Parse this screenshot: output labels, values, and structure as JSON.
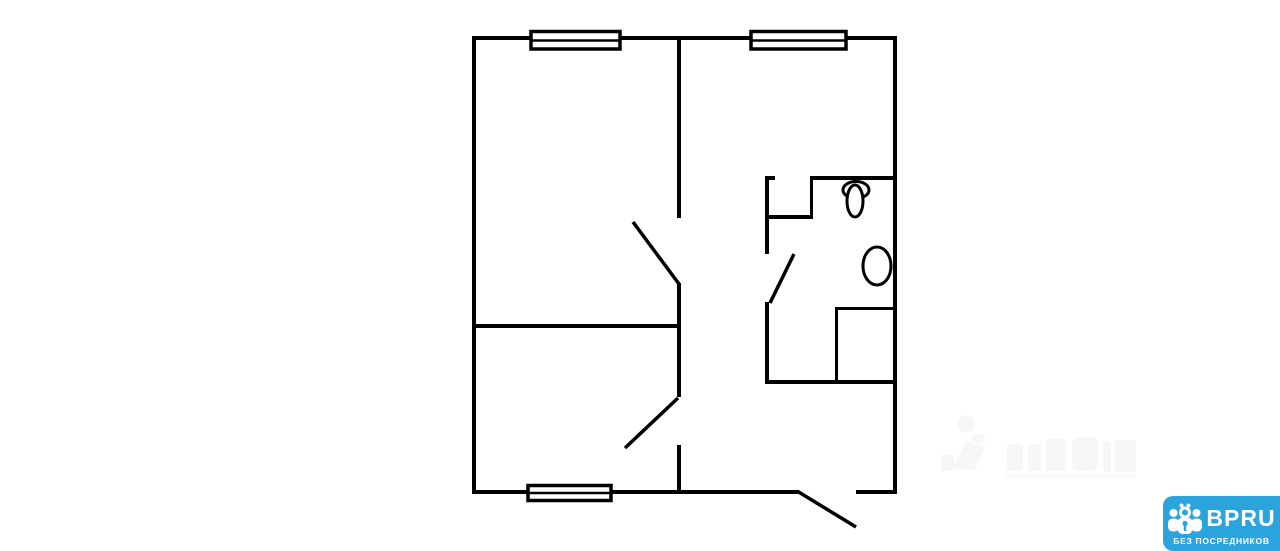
{
  "canvas": {
    "width": 1280,
    "height": 551,
    "background": "#ffffff"
  },
  "floorplan": {
    "line_color": "#000000",
    "window_count": 3,
    "door_swing_count": 4,
    "fixtures": [
      "toilet",
      "sink"
    ]
  },
  "watermark": {
    "color": "#f7f7f7"
  },
  "logo": {
    "brand": "BPRU",
    "tagline": "БЕЗ ПОСРЕДНИКОВ",
    "background_color": "#2ba3dc",
    "text_color": "#ffffff",
    "icon": "people-group-icon"
  }
}
